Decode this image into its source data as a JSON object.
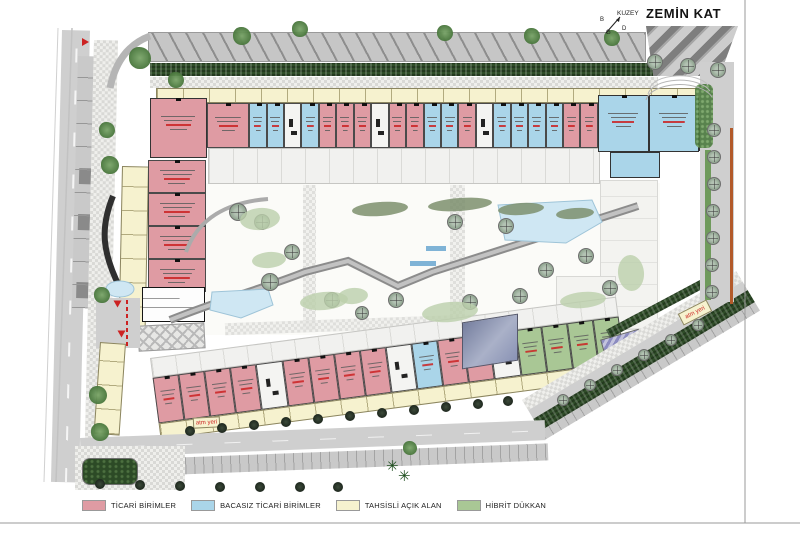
{
  "sheet": {
    "title": "ZEMİN KAT",
    "north_label": "KUZEY",
    "compass": {
      "b": "B",
      "g": "G",
      "d": "D"
    }
  },
  "legend": {
    "items": [
      {
        "key": "ticari",
        "label": "TİCARİ BİRİMLER",
        "color": "#df9ba3"
      },
      {
        "key": "bacasiz",
        "label": "BACASIZ TİCARİ BİRİMLER",
        "color": "#aad5e9"
      },
      {
        "key": "tahsisli",
        "label": "TAHSİSLİ AÇIK ALAN",
        "color": "#f6f2cf"
      },
      {
        "key": "hibrit",
        "label": "HİBRİT DÜKKAN",
        "color": "#a9c795"
      }
    ]
  },
  "annotations": {
    "atm_label": "atm yeri"
  },
  "palette": {
    "red": "#cc2222",
    "hedge": "#2f4d28",
    "road": "#cfcfcf",
    "water": "#cfe7f3",
    "water_edge": "#9ec4d8",
    "purple": "#9a9ac6",
    "slate": "#8a93b5",
    "boundary": "#b35a2a",
    "wall": "#4a4a4a"
  },
  "plan": {
    "rows": {
      "top": "P b b w b p p p w p p b b p w b b b b p p",
      "bottom": "p p p p w p p p p w b p p w g g g g",
      "left": "p p p p"
    }
  },
  "icons": {
    "palm": "✳"
  }
}
